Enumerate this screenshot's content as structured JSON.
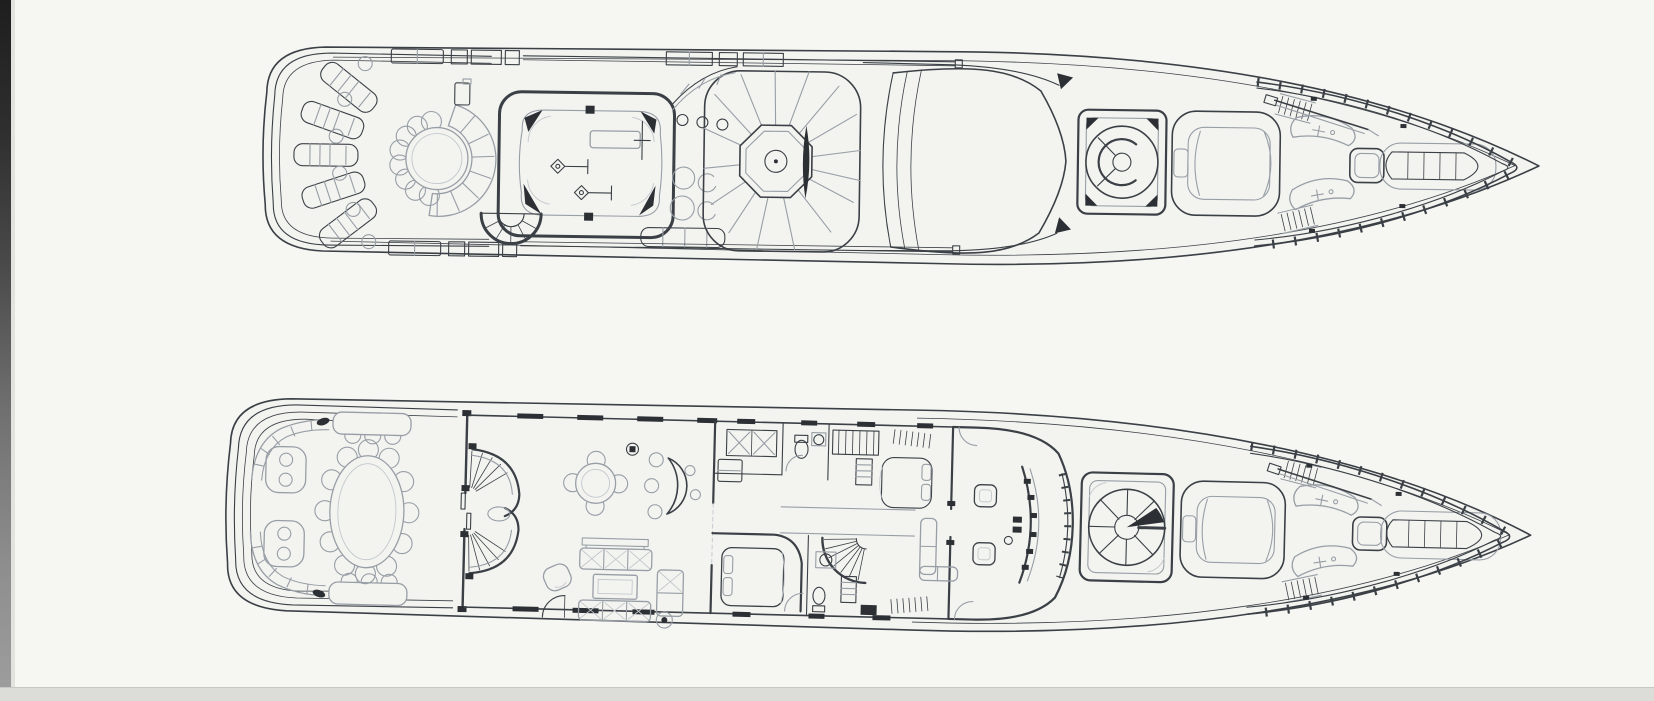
{
  "palette": {
    "paper": "#f6f6f2",
    "hull": "#f3f4f0",
    "ink": "#3b4046",
    "inklt": "#989ea6",
    "inkft": "#c3c8cd",
    "inkdk": "#2c3035",
    "scantop": "#1e1e1e",
    "scanmid": "#8d8d8d",
    "band": "#dcdcd8"
  },
  "document": {
    "kind": "scanned yacht general-arrangement drawing",
    "text_visible": "",
    "plans": [
      {
        "id": "sun-deck-plan",
        "label": "Sun deck / upper deck plan (aft sun loungers, round table with curved bench, gym skylight, spa octagon with fan sunpads, radar arch, capstan, tender cradle, foredeck sunpads, bow railing)",
        "features": [
          "hull-outline",
          "sun-loungers",
          "side-tables",
          "round-table",
          "curved-bench",
          "rail-boxes",
          "gym-room",
          "exercise-bench",
          "weight-stations",
          "stern-stair",
          "portholes",
          "deck-stools",
          "fan-sunpad",
          "spa-octagon",
          "curved-counter",
          "walkway-rails",
          "radar-arch",
          "capstan-box",
          "tender-cradle",
          "side-steps",
          "foredeck-sunpads",
          "foredeck-boat",
          "crane-davit",
          "bow-railing"
        ]
      },
      {
        "id": "main-deck-plan",
        "label": "Main deck plan (aft deck benches and settees, oval dining table, twin curved stairs, salon with bar and sofas, galley, cabins, spiral stair, wheelhouse with helm chairs and console, capstan platform, tender cradle, foredeck sunpads, bow railing)",
        "features": [
          "hull-outline",
          "stern-benches",
          "settees",
          "aft-tables",
          "cleats",
          "oval-dining-table",
          "bulkhead-door",
          "curved-stairs",
          "game-table",
          "bar-counter",
          "bar-stools",
          "sofa-group",
          "coffee-table",
          "chaise",
          "armchair",
          "galley-counter",
          "fridge",
          "wc-toilet",
          "wc-sink",
          "straight-stair",
          "locker",
          "guest-bed",
          "spiral-stair",
          "vip-bed",
          "bathroom",
          "wheelhouse",
          "helm-chairs",
          "helm-console",
          "settee-L",
          "capstan-platform",
          "tender-cradle",
          "side-steps",
          "foredeck-sunpads",
          "foredeck-boat",
          "crane-davit",
          "bow-railing"
        ]
      }
    ]
  }
}
